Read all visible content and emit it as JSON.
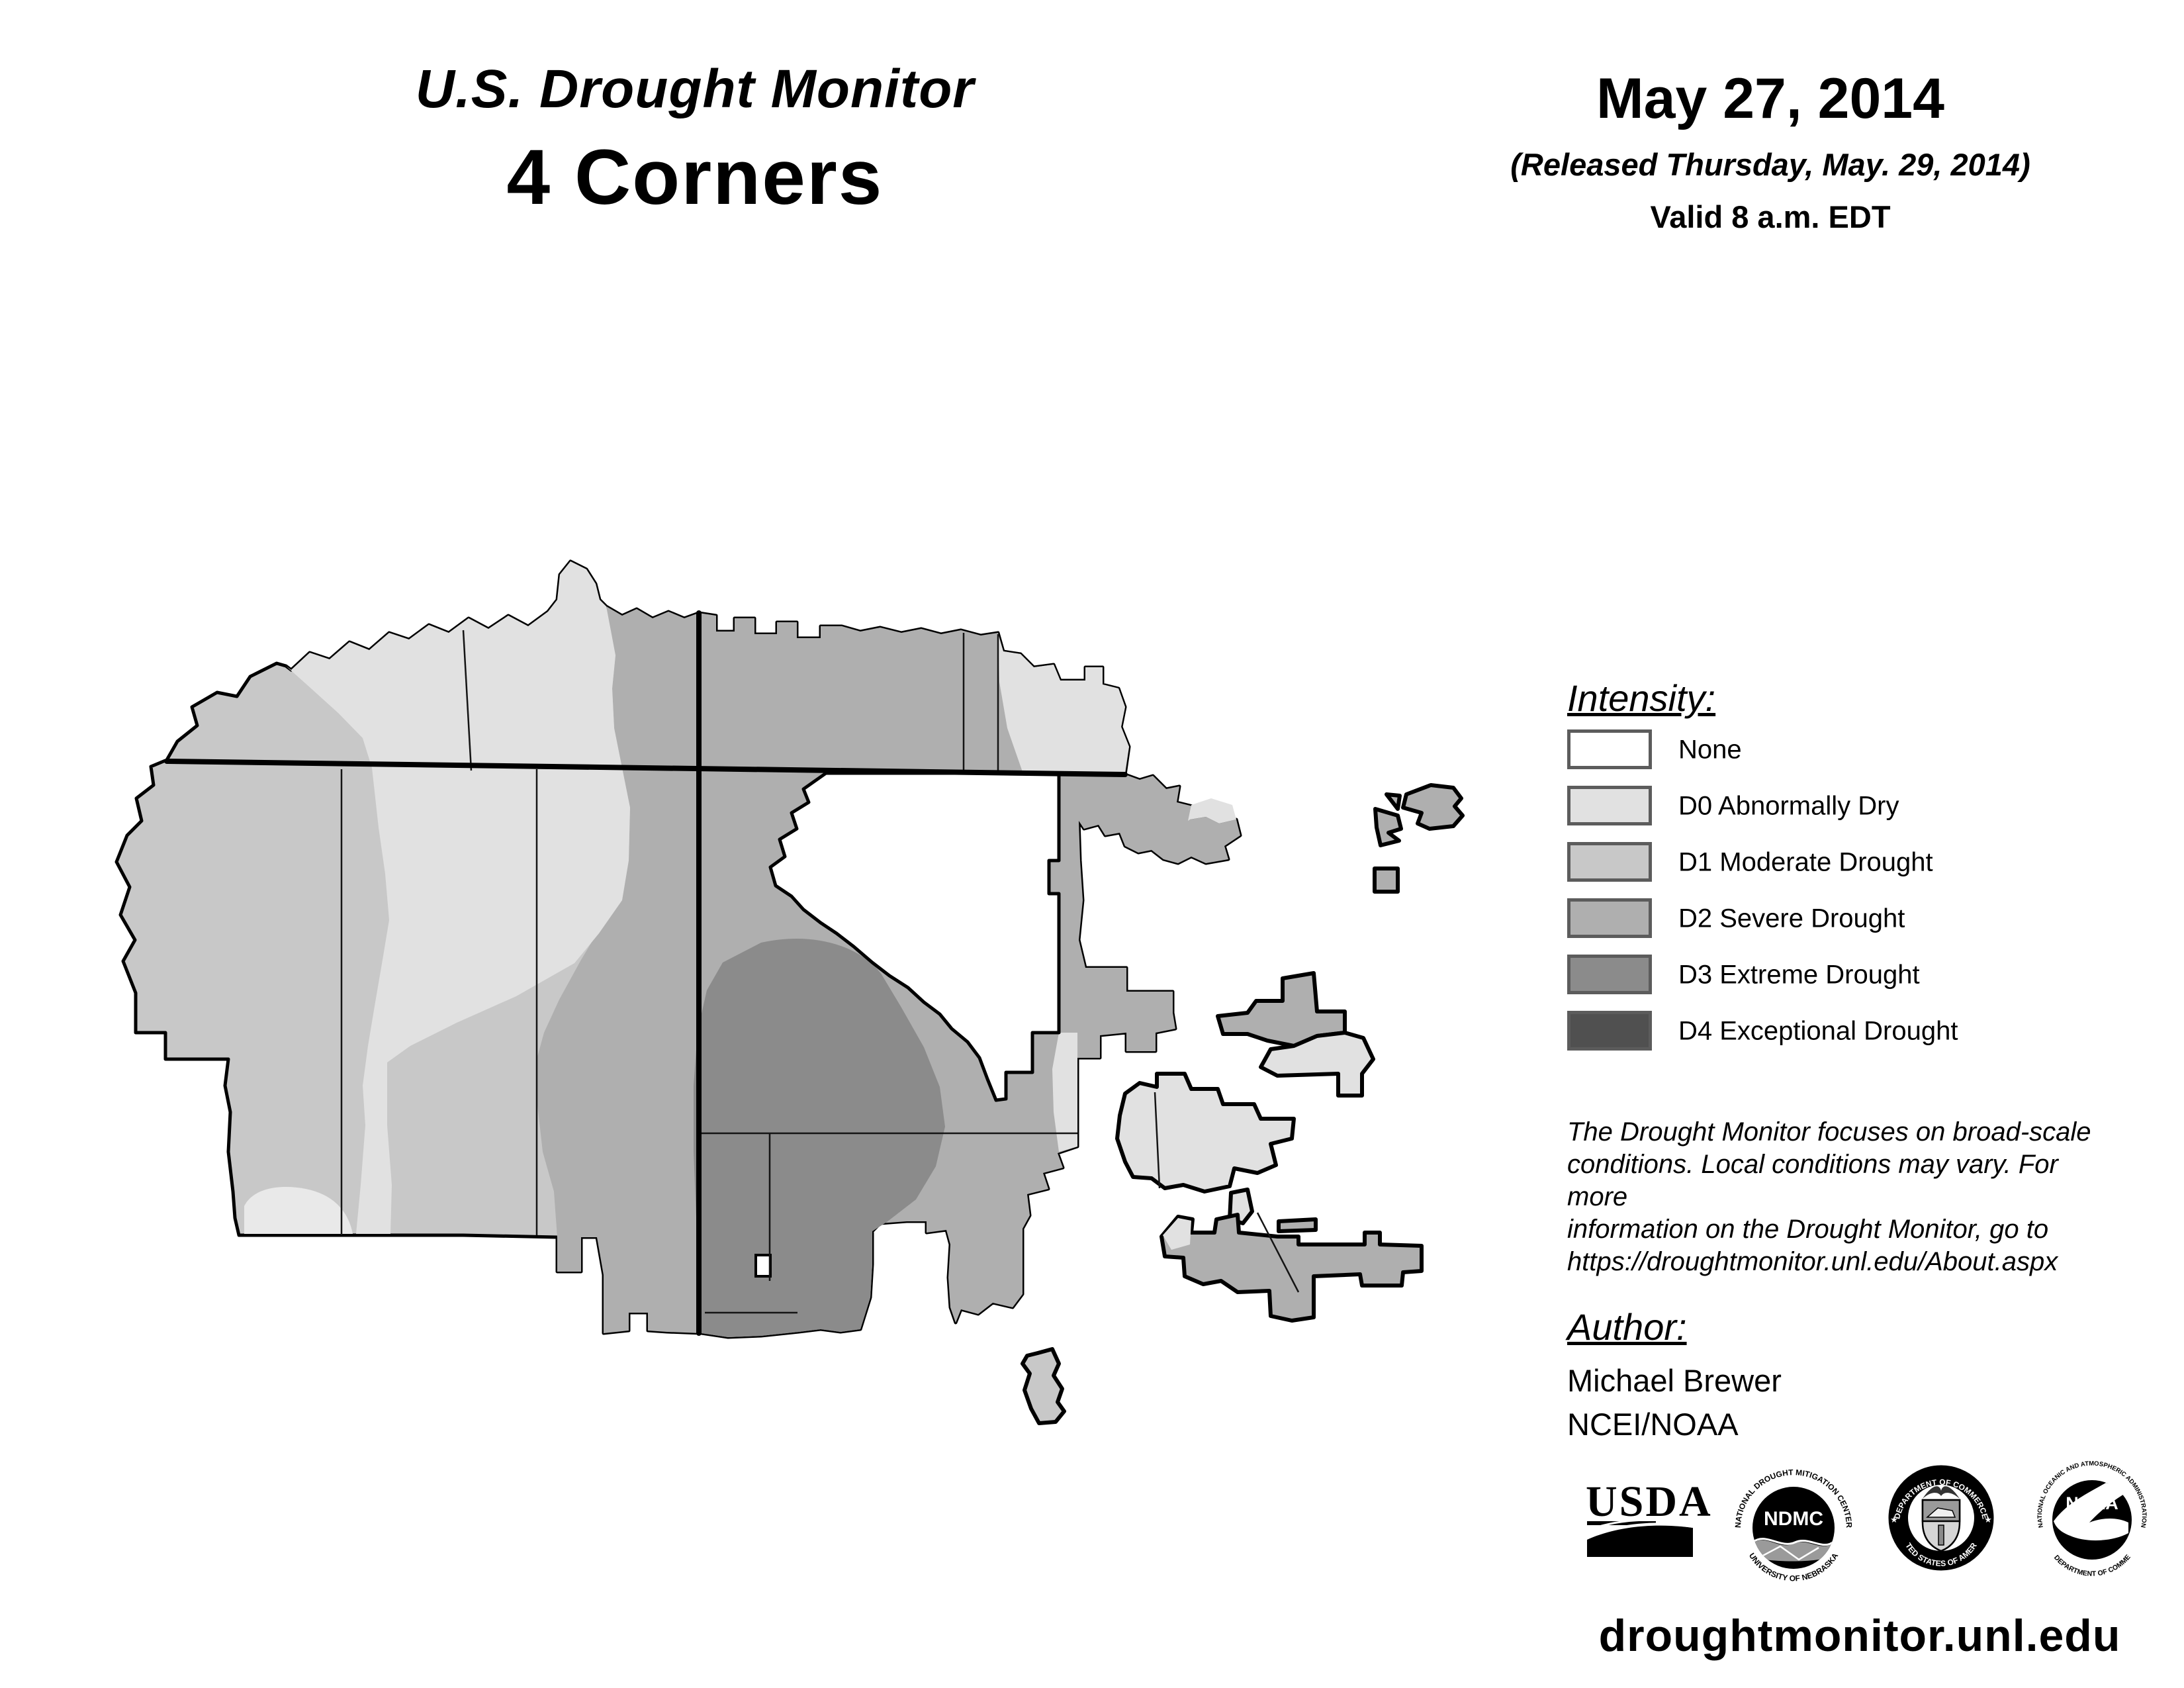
{
  "header": {
    "title_line1": "U.S. Drought Monitor",
    "title_line2": "4 Corners",
    "date": "May 27, 2014",
    "released": "(Released Thursday, May. 29, 2014)",
    "valid": "Valid 8 a.m. EDT"
  },
  "legend": {
    "heading": "Intensity:",
    "items": [
      {
        "label": "None",
        "color": "#ffffff"
      },
      {
        "label": "D0 Abnormally Dry",
        "color": "#e1e1e1"
      },
      {
        "label": "D1 Moderate Drought",
        "color": "#c8c8c8"
      },
      {
        "label": "D2 Severe Drought",
        "color": "#afafaf"
      },
      {
        "label": "D3 Extreme Drought",
        "color": "#8b8b8b"
      },
      {
        "label": "D4 Exceptional Drought",
        "color": "#505050"
      }
    ]
  },
  "notes_lines": [
    "The Drought Monitor focuses on broad-scale",
    "conditions. Local conditions may vary. For more",
    "information on the Drought Monitor, go to",
    "https://droughtmonitor.unl.edu/About.aspx"
  ],
  "author": {
    "heading": "Author:",
    "name": "Michael Brewer",
    "org": "NCEI/NOAA"
  },
  "footer_url": "droughtmonitor.unl.edu",
  "seals": {
    "usda": {
      "label": "USDA"
    },
    "ndmc": {
      "center": "NDMC",
      "ring_top": "NATIONAL DROUGHT MITIGATION CENTER",
      "ring_bottom": "UNIVERSITY OF NEBRASKA"
    },
    "commerce": {
      "ring_top": "DEPARTMENT OF COMMERCE",
      "ring_bottom": "UNITED STATES OF AMERICA",
      "star_left": "★",
      "star_right": "★"
    },
    "noaa": {
      "center": "NOAA",
      "ring_top": "NATIONAL OCEANIC AND ATMOSPHERIC ADMINISTRATION",
      "ring_bottom": "U.S. DEPARTMENT OF COMMERCE"
    }
  }
}
